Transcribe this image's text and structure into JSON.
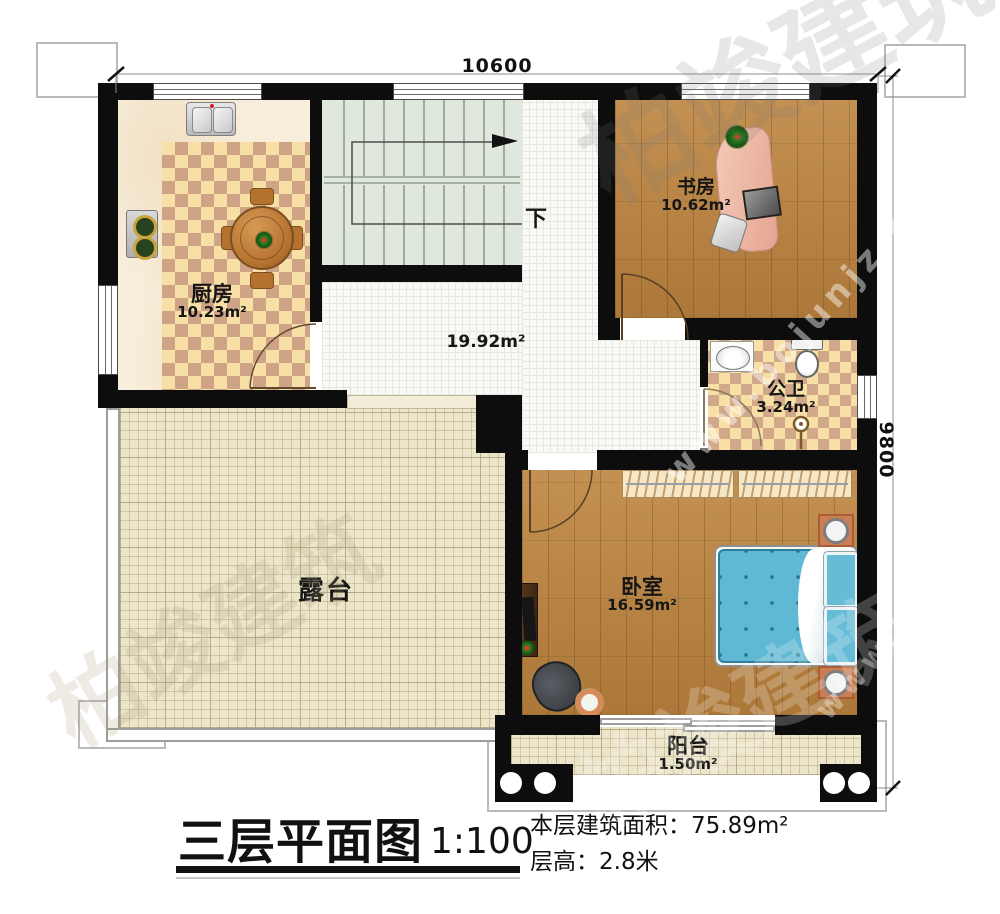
{
  "dimensions": {
    "top": "10600",
    "right": "9800"
  },
  "rooms": {
    "kitchen": {
      "name": "厨房",
      "area": "10.23m²"
    },
    "study": {
      "name": "书房",
      "area": "10.62m²"
    },
    "bathroom": {
      "name": "公卫",
      "area": "3.24m²"
    },
    "bedroom": {
      "name": "卧室",
      "area": "16.59m²"
    },
    "hall": {
      "area": "19.92m²"
    },
    "terrace": {
      "name": "露台"
    },
    "balcony": {
      "name": "阳台",
      "area": "1.50m²"
    },
    "stairs": {
      "down": "下"
    }
  },
  "title_block": {
    "title": "三层平面图",
    "scale": "1:100",
    "area_line": "本层建筑面积：75.89m²",
    "floor_height_line": "层高：2.8米"
  },
  "watermarks": [
    {
      "text": "柏竣建筑"
    },
    {
      "text": "www.bojunjz.com"
    },
    {
      "text": "柏竣建筑"
    },
    {
      "text": "柏竣建筑"
    },
    {
      "text": "www.bojunjz.com"
    }
  ],
  "colors": {
    "wall": "#0d0d0d",
    "wood": "#b9823f",
    "checker_light": "#f7dfa6",
    "checker_dark": "#cfa386",
    "corridor_tile": "#f9f9f6",
    "terrace": "#ece5ca",
    "stair": "#e0e7dd",
    "bed_blue": "#5fb9d4",
    "nightstand_orange": "#c97e53"
  }
}
